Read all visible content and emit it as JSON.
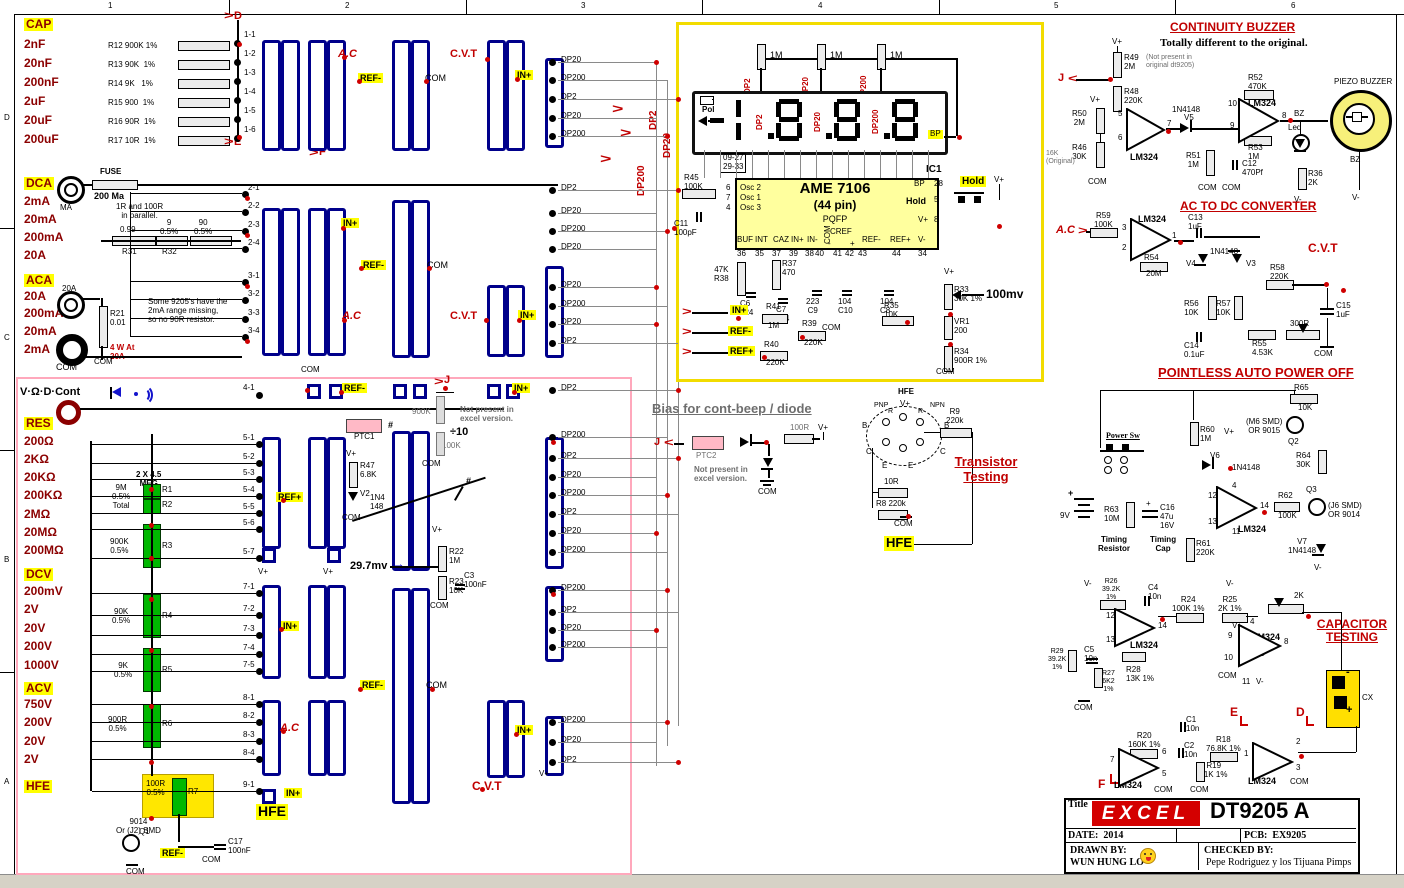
{
  "sym": {
    "gt": ">",
    "lt": "<",
    "plus": "+",
    "minus": "-",
    "arrow_r": "→"
  },
  "ruler": {
    "c": [
      "1",
      "2",
      "3",
      "4",
      "5",
      "6"
    ],
    "r": [
      "D",
      "C",
      "B",
      "A"
    ]
  },
  "cap": {
    "t": "CAP",
    "rg": [
      "2nF",
      "20nF",
      "200nF",
      "2uF",
      "20uF",
      "200uF"
    ],
    "rs": [
      "R12 900K 1%",
      "R13 90K  1%",
      "R14 9K   1%",
      "R15 900  1%",
      "R16 90R  1%",
      "R17 10R  1%"
    ],
    "tm": [
      "1-1",
      "1-2",
      "1-3",
      "1-4",
      "1-5",
      "1-6"
    ],
    "d": "D",
    "e": "E",
    "f": "F"
  },
  "dca": {
    "t": "DCA",
    "rg": [
      "2mA",
      "20mA",
      "200mA",
      "20A"
    ],
    "fuse": "FUSE",
    "fv": "200 Ma",
    "jack": "MA",
    "note": "1R and 100R\nin parallel.",
    "r31v": "0.99",
    "r31": "R31",
    "r32v": "9\n0.5%",
    "r32": "R32",
    "r90": "90\n0.5%",
    "tm": [
      "2-1",
      "2-2",
      "2-3",
      "2-4"
    ]
  },
  "aca": {
    "t": "ACA",
    "rg": [
      "20A",
      "200mA",
      "20mA",
      "2mA"
    ],
    "jack": "20A",
    "r21": "R21\n0.01",
    "watt": "4 W At\n20A",
    "note": "Some 9205's have the\n2mA range missing,\nso no 90R resistor.",
    "tm": [
      "3-1",
      "3-2",
      "3-3",
      "3-4"
    ]
  },
  "vod": {
    "t": "V·Ω·D·Cont"
  },
  "res": {
    "t": "RES",
    "rg": [
      "200Ω",
      "2KΩ",
      "20KΩ",
      "200KΩ",
      "2MΩ",
      "20MΩ",
      "200MΩ"
    ]
  },
  "dcv": {
    "t": "DCV",
    "rg": [
      "200mV",
      "2V",
      "20V",
      "200V",
      "1000V"
    ]
  },
  "acv": {
    "t": "ACV",
    "rg": [
      "750V",
      "200V",
      "20V",
      "2V"
    ]
  },
  "hfe": {
    "t": "HFE"
  },
  "ladder": {
    "meg": "2 X 4.5\nMEG",
    "r12v": "9M\n0.5%\nTotal",
    "r1": "R1",
    "r2": "R2",
    "r3v": "900K\n0.5%",
    "r3": "R3",
    "r4v": "90K\n0.5%",
    "r4": "R4",
    "r5v": "9K\n0.5%",
    "r5": "R5",
    "r6v": "900R\n0.5%",
    "r6": "R6",
    "r7v": "100R\n0.5%",
    "r7": "R7",
    "q1t": "9014\nOr (J2) SMD",
    "q1": "Q1",
    "c17": "C17\n100nF"
  },
  "mid": {
    "t41": "4-1",
    "t5": [
      "5-1",
      "5-2",
      "5-3",
      "5-4",
      "5-5",
      "5-6",
      "5-7"
    ],
    "t7": [
      "7-1",
      "7-2",
      "7-3",
      "7-4",
      "7-5"
    ],
    "t8": [
      "8-1",
      "8-2",
      "8-3",
      "8-4"
    ],
    "t9": "9-1",
    "mv": "29.7mv",
    "ptc1": "PTC1",
    "r47": "R47\n6.8K",
    "v2": "V2",
    "v2d": "1N4\n148",
    "k900": "900K",
    "d10": "÷10",
    "k100": "100K",
    "np": "Not present in\nexcel version.",
    "r22": "R22\n1M",
    "r23": "R23\n10K",
    "c3": "C3\n100nF",
    "hash": "#"
  },
  "common": {
    "com": "COM",
    "vp": "V+",
    "vm": "V-",
    "inp": "IN+",
    "refm": "REF-",
    "refp": "REF+",
    "ac": "A.C",
    "cvt": "C.V.T",
    "lm": "LM324",
    "hfe": "HFE",
    "j": "J",
    "n41": "1N4148"
  },
  "dpcol": {
    "g1": [
      "DP20",
      "DP200",
      "DP2",
      "DP20",
      "DP200"
    ],
    "g2": [
      "DP2",
      "DP20",
      "DP200",
      "DP20"
    ],
    "g3": [
      "DP20",
      "DP200",
      "DP20",
      "DP2"
    ],
    "g4": [
      "DP2",
      "DP200",
      "DP2",
      "DP20",
      "DP200",
      "DP2",
      "DP20",
      "DP200"
    ],
    "g5": [
      "DP200",
      "DP2",
      "DP20",
      "DP200"
    ],
    "g6": [
      "DP200",
      "DP20",
      "DP2"
    ],
    "b2": "DP2",
    "b20": "DP20",
    "b200": "DP200"
  },
  "disp": {
    "r1m": "1M",
    "pol": "Pol",
    "bp": "BP",
    "ic1": "IC1",
    "pins": "09-27\n29-33",
    "chip": "AME 7106",
    "pkg": "(44 pin)",
    "pqfp": "PQFP",
    "osc": [
      "6",
      "7",
      "4"
    ],
    "oscl": [
      "Osc 2",
      "Osc 1",
      "Osc 3"
    ],
    "r45": "R45\n100K",
    "c11": "C11\n100pF",
    "p28": "28",
    "p5": "5",
    "p8": "8",
    "hold": "Hold",
    "bot": [
      "BUF",
      "INT",
      "CAZ",
      "IN+",
      "IN-",
      "CREF",
      "-",
      "+",
      "REF-",
      "REF+",
      "V-"
    ],
    "botn": [
      "36",
      "35",
      "37",
      "39",
      "38",
      "40",
      "41",
      "42",
      "43",
      "44",
      "34"
    ],
    "r38": "47K\nR38",
    "r37": "R37\n470",
    "c6": "C6\n224",
    "c7": "C7\n224",
    "c9": "223\nC9",
    "c10": "104\nC10",
    "c8": "104\nC8",
    "r41": "R41",
    "r41v": "1M",
    "r39": "R39",
    "r39v": "220K",
    "r40": "R40",
    "r40v": "220K",
    "r35": "R35\n10K",
    "r33": "R33\n30K 1%",
    "vr1": "VR1\n200",
    "r34": "R34\n900R 1%",
    "mv": "100mv"
  },
  "bias": {
    "t": "Bias for cont-beep / diode",
    "ptc2": "PTC2",
    "np": "Not present in\nexcel version.",
    "r100": "100R"
  },
  "tt": {
    "t": "Transistor\nTesting",
    "hfe": "HFE",
    "pnp": "PNP",
    "npn": "NPN",
    "b": "B",
    "c": "C",
    "e": "E",
    "r": "R",
    "r9": "R9\n220k",
    "r10": "10R",
    "r8": "R8 220k"
  },
  "cb": {
    "t": "CONTINUITY BUZZER",
    "sub": "Totally different to the original.",
    "r49": "R49\n2M",
    "r49n": "(Not present in\noriginal dt9205)",
    "r48": "R48\n220K",
    "r50": "R50\n2M",
    "r46": "R46\n30K",
    "orig": "16K\n(Original)",
    "ic": "IC2.B",
    "p5": "5",
    "p6": "6",
    "p7": "7",
    "v5": "V5",
    "r51": "R51\n1M",
    "c12": "C12\n470Pf",
    "r52": "R52\n470K",
    "ic2": "IC2.C",
    "p10": "10",
    "p9": "9",
    "p8": "8",
    "r53": "R53\n1M",
    "bz": "BZ",
    "led": "Led",
    "r36": "R36\n2K",
    "pb": "PIEZO BUZZER"
  },
  "ad": {
    "t": "AC TO DC CONVERTER",
    "r59": "R59\n100K",
    "ic": "IC2.A",
    "p3": "3",
    "p2": "2",
    "p1": "1",
    "r54": "R54",
    "r54v": "20M",
    "c13": "C13\n1uF",
    "v4": "V4",
    "v3": "V3",
    "r58": "R58\n220K",
    "r56": "R56\n10K",
    "r57": "R57\n10K",
    "c14": "C14\n0.1uF",
    "r55": "R55\n4.53K",
    "pot": "300R",
    "c15": "C15\n1uF"
  },
  "apo": {
    "t": "POINTLESS AUTO POWER OFF",
    "psw": "Power Sw",
    "bat": "9V",
    "r63": "R63\n10M",
    "tr": "Timing\nResistor",
    "c16": "C16\n47u\n16V",
    "tc": "Timing\nCap",
    "r60": "R60\n1M",
    "v6": "V6",
    "ic": "IC2.D",
    "p12": "12",
    "p13": "13",
    "p4": "4",
    "p14": "14",
    "p11": "11",
    "r61": "R61\n220K",
    "r62": "R62",
    "r62v": "100K",
    "r65": "R65",
    "r65v": "10K",
    "q2": "Q2",
    "q2t": "(M6 SMD)\nOR 9015",
    "r64": "R64\n30K",
    "q3": "Q3",
    "q3t": "(J6 SMD)\nOR 9014",
    "v7": "V7\n1N4148"
  },
  "ct": {
    "t": "CAPACITOR\nTESTING",
    "r26": "R26\n39.2K\n1%",
    "c4": "C4\n10n",
    "r24": "R24\n100K 1%",
    "r25": "R25\n2K 1%",
    "p2k": "2K",
    "icd": "IC3 D",
    "p12": "12",
    "p13": "13",
    "p14": "14",
    "c5": "C5\n10n",
    "r29": "R29\n39.2K\n1%",
    "r27": "R27\n6K2\n1%",
    "r28": "R28\n13K 1%",
    "icc": "IC3 C",
    "p9": "9",
    "p10": "10",
    "p8": "8",
    "p4": "4",
    "p11": "11",
    "cx": "CX",
    "e": "E",
    "d": "D",
    "f": "F",
    "r20": "R20\n160K 1%",
    "c1": "C1\n10n",
    "c2": "C2\n10n",
    "r18": "R18\n76.8K 1%",
    "r19": "R19\n11K 1%",
    "icb": "IC3B",
    "p7": "7",
    "p6": "6",
    "p5": "5",
    "ica": "IC3 A",
    "p1": "1",
    "p2": "2",
    "p3": "3"
  },
  "tb": {
    "title": "Title",
    "logo": "EXCEL",
    "model": "DT9205 A",
    "date": "DATE:  2014",
    "pcb": "PCB:  EX9205",
    "drawn": "DRAWN BY:",
    "drawn_name": "WUN HUNG LO",
    "checked": "CHECKED BY:",
    "checked_name": "Pepe Rodriguez y los Tijuana Pimps"
  }
}
